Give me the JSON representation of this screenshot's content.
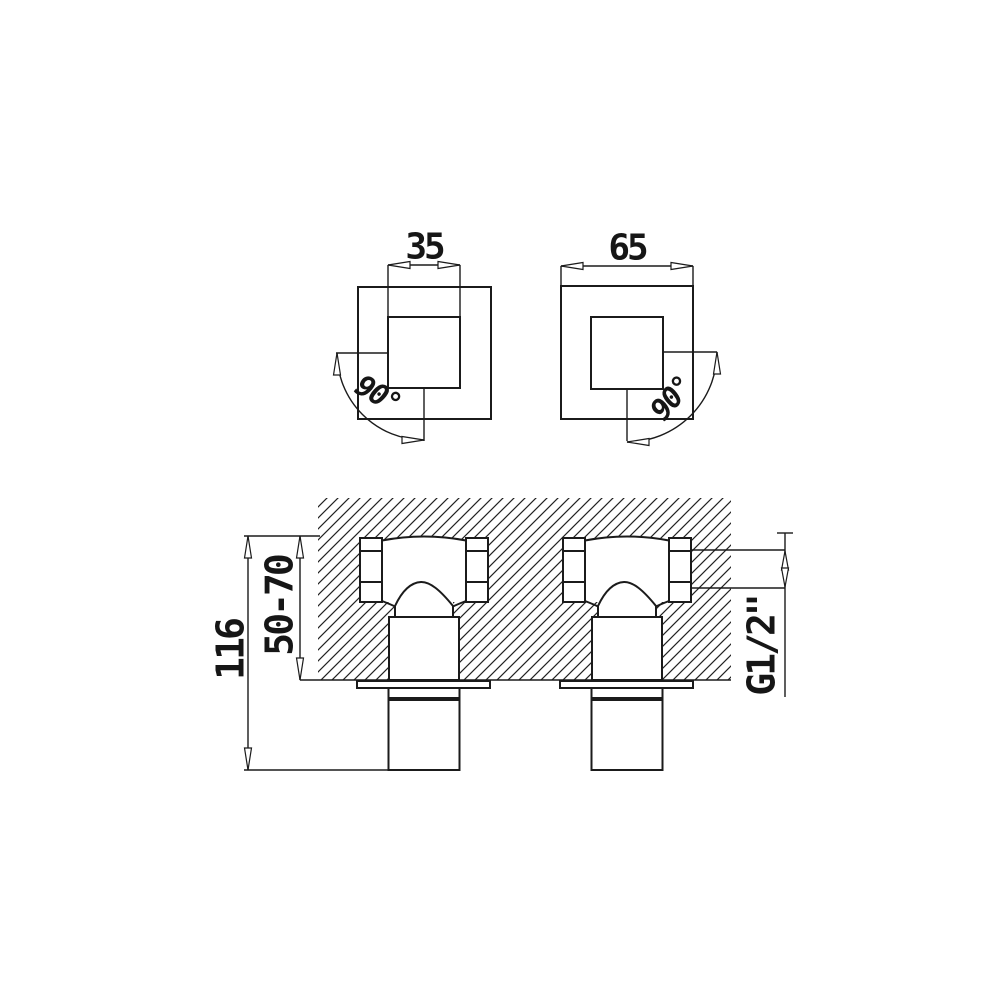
{
  "drawing": {
    "background_color": "#ffffff",
    "line_color": "#1b1b1b",
    "top_view_left": {
      "width_label": "35",
      "rotation_label": "90°"
    },
    "top_view_right": {
      "width_label": "65",
      "rotation_label": "90°"
    },
    "section_view": {
      "overall_height_label": "116",
      "embedment_depth_label": "50-70",
      "thread_size_label": "G1/2\""
    }
  }
}
